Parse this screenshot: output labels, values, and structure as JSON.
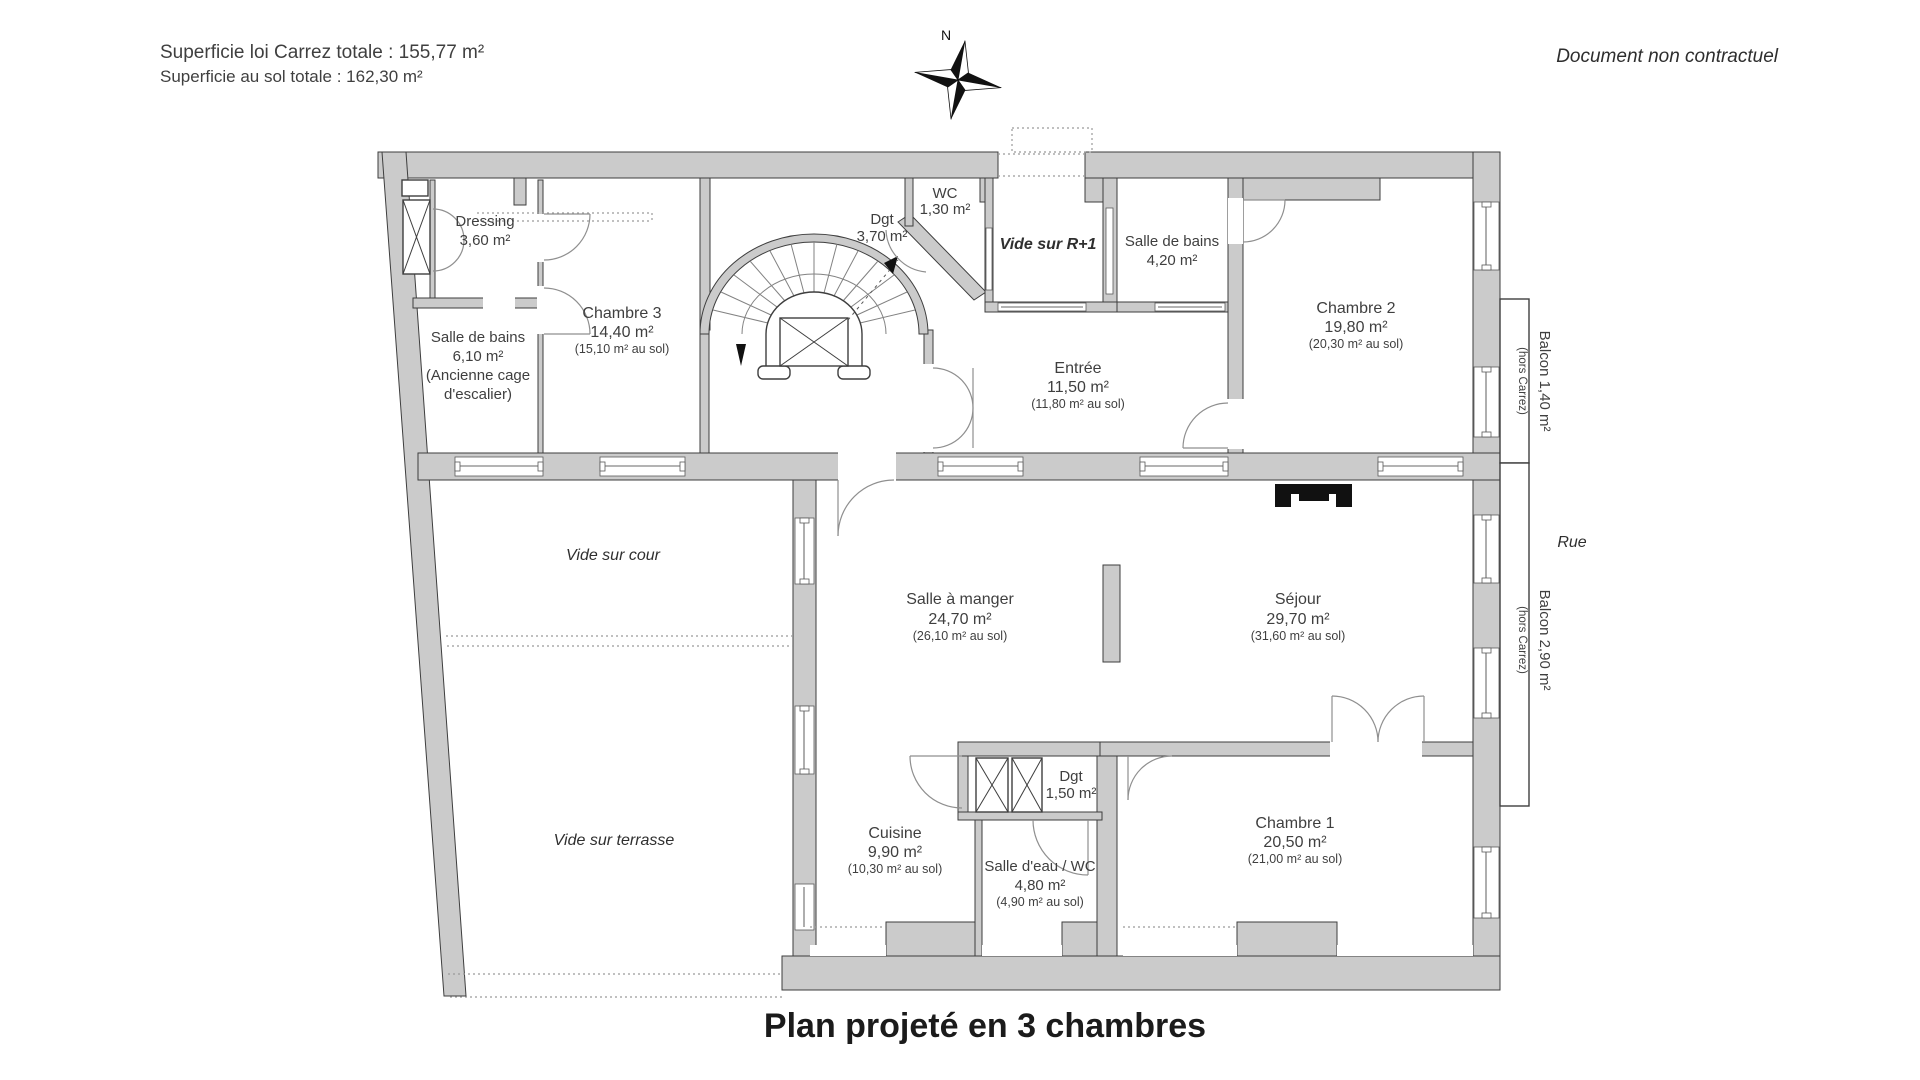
{
  "header": {
    "superficie_carrez": "Superficie loi Carrez totale : 155,77 m²",
    "superficie_sol": "Superficie au sol totale : 162,30 m²",
    "disclaimer": "Document non contractuel",
    "compass_north": "N"
  },
  "title": "Plan projeté en 3 chambres",
  "rooms": {
    "dressing": {
      "name": "Dressing",
      "area": "3,60 m²"
    },
    "sdb_haut": {
      "name": "Salle de bains",
      "area": "6,10 m²",
      "note1": "(Ancienne cage",
      "note2": "d'escalier)"
    },
    "chambre3": {
      "name": "Chambre 3",
      "area": "14,40 m²",
      "floor": "(15,10 m² au sol)"
    },
    "dgt_haut": {
      "name": "Dgt",
      "area": "3,70 m²"
    },
    "wc": {
      "name": "WC",
      "area": "1,30 m²"
    },
    "vide_r1": {
      "name": "Vide sur R+1"
    },
    "sdb_420": {
      "name": "Salle de bains",
      "area": "4,20 m²"
    },
    "chambre2": {
      "name": "Chambre 2",
      "area": "19,80 m²",
      "floor": "(20,30 m² au sol)"
    },
    "entree": {
      "name": "Entrée",
      "area": "11,50 m²",
      "floor": "(11,80 m² au sol)"
    },
    "vide_cour": {
      "name": "Vide sur cour"
    },
    "salle_a_manger": {
      "name": "Salle à manger",
      "area": "24,70 m²",
      "floor": "(26,10 m² au sol)"
    },
    "sejour": {
      "name": "Séjour",
      "area": "29,70 m²",
      "floor": "(31,60 m² au sol)"
    },
    "vide_terrasse": {
      "name": "Vide sur terrasse"
    },
    "cuisine": {
      "name": "Cuisine",
      "area": "9,90 m²",
      "floor": "(10,30 m² au sol)"
    },
    "dgt_bas": {
      "name": "Dgt",
      "area": "1,50 m²"
    },
    "salle_eau": {
      "name": "Salle d'eau / WC",
      "area": "4,80 m²",
      "floor": "(4,90 m² au sol)"
    },
    "chambre1": {
      "name": "Chambre 1",
      "area": "20,50 m²",
      "floor": "(21,00 m² au sol)"
    }
  },
  "exterior": {
    "balcon1": {
      "name": "Balcon 1,40 m²",
      "note": "(hors Carrez)"
    },
    "balcon2": {
      "name": "Balcon 2,90 m²",
      "note": "(hors Carrez)"
    },
    "rue": "Rue"
  },
  "colors": {
    "wall": "#cbcbcb",
    "line": "#3e3e3e",
    "text": "#3f3f3f",
    "title": "#1b1b1b"
  }
}
